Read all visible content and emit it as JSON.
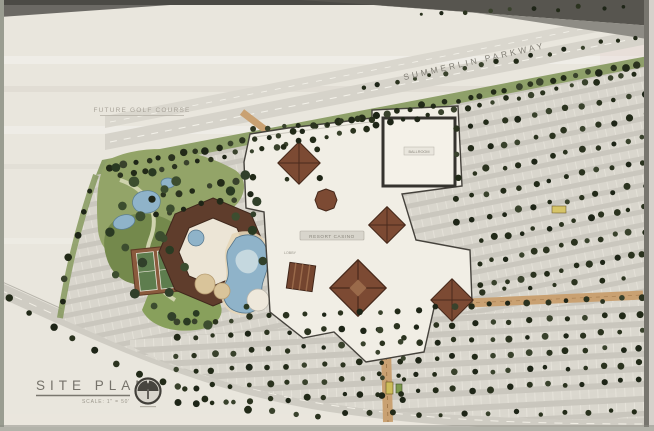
{
  "board": {
    "title": "SITE PLAN",
    "scale_note": "SCALE: 1\" = 50'",
    "road_label": "SUMMERLIN PARKWAY",
    "area_label": "FUTURE GOLF COURSE",
    "building_label": "RESORT CASINO",
    "annex_label": "BALLROOM",
    "lobby_label": "LOBBY"
  },
  "colors": {
    "paper": "#e9e6dd",
    "road_gray": "#d6d3ca",
    "tree_dark": "#262e1b",
    "garden_green": "#8ba05e",
    "pool_blue": "#8fb3c9",
    "roof_brown": "#7c4a33",
    "building_cream": "#f1eee5",
    "frame_dark": "#57554f"
  }
}
